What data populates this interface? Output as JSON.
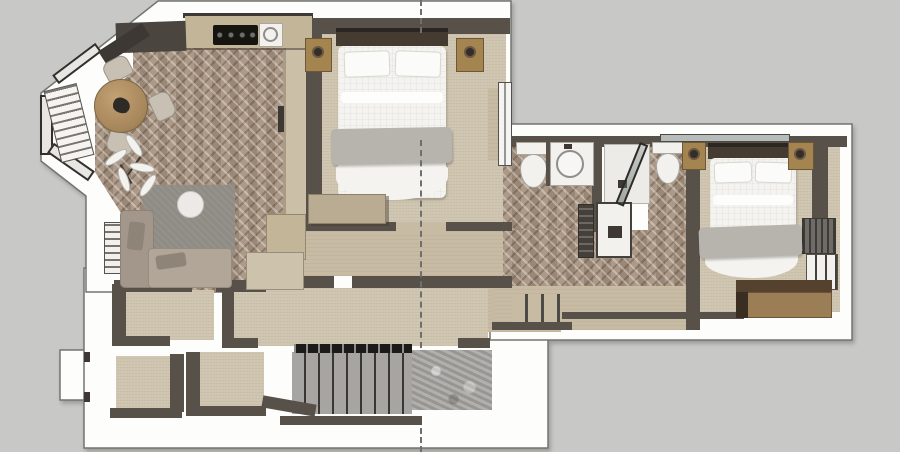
{
  "canvas": {
    "width": 900,
    "height": 452,
    "description": "3D rendered top-down apartment floor plan (SketchUp style), no visible text"
  },
  "palette": {
    "background": "#c8c9c6",
    "wall-white": "#fdfdfc",
    "wall-outline": "#74746f",
    "wall-dark": "#57514a",
    "wall-dark-2": "#3d3833",
    "parquet-base": "#a6917e",
    "carpet": "#cfc5b0",
    "corridor": "#c7bba4",
    "counter": "#c3b698",
    "cabinet-dark": "#4a453f",
    "wood": "#b2925f",
    "chair": "#c8c1b3",
    "sofa": "#b2a698",
    "sofa-2": "#a3968a",
    "rug": "#8e8c85",
    "table-white": "#eceae6",
    "bed-white": "#f4f3f0",
    "blanket": "#b7b4ad",
    "headboard": "#463b30",
    "nightstand": "#a5854f",
    "stone": "#a7a5a1",
    "railing": "#1d1b19",
    "fixture": "#f2f1ee",
    "fixture-line": "#a9a7a2",
    "dresser-top": "#54422f",
    "dresser-front": "#9b7e55",
    "radiator": "#6f6b66",
    "glass": "#b7bcbb",
    "section": "#6f6f6d"
  },
  "rooms": [
    {
      "id": "living-dining-kitchen",
      "floor": "herringbone-parquet",
      "furniture": [
        "kitchen-counter",
        "cooktop",
        "kitchen-sink",
        "tall-dark-cabinet",
        "round-dining-table",
        "dining-chairs",
        "bay-window",
        "window-bench",
        "plant",
        "corner-sofa",
        "area-rug",
        "round-coffee-table",
        "louvered-side-cabinet"
      ]
    },
    {
      "id": "bedroom-1",
      "floor": "carpet",
      "furniture": [
        "double-bed",
        "headboard",
        "pillows",
        "gray-blanket",
        "nightstand-left",
        "nightstand-right",
        "table-lamps",
        "dresser",
        "wardrobe-column",
        "window"
      ]
    },
    {
      "id": "bathroom-1",
      "floor": "herringbone-parquet",
      "furniture": [
        "toilet",
        "vanity-sink"
      ]
    },
    {
      "id": "shower-room",
      "floor": "tile-and-parquet",
      "furniture": [
        "shower-tray",
        "glass-door",
        "toilet"
      ]
    },
    {
      "id": "laundry-nook",
      "floor": "herringbone-parquet",
      "furniture": [
        "washing-machine",
        "tall-cabinet"
      ]
    },
    {
      "id": "bedroom-2",
      "floor": "carpet",
      "furniture": [
        "double-bed",
        "headboard",
        "pillows",
        "gray-blanket",
        "nightstand-left",
        "nightstand-right",
        "wardrobe",
        "radiator",
        "balcony-door",
        "dresser"
      ]
    },
    {
      "id": "hallway",
      "floor": "carpet",
      "furniture": [
        "steps"
      ]
    },
    {
      "id": "stair-hall",
      "floor": "stone",
      "furniture": [
        "staircase",
        "railing",
        "landing"
      ]
    },
    {
      "id": "lower-rooms",
      "floor": "carpet",
      "furniture": []
    }
  ],
  "annotations": {
    "section_line": {
      "orientation": "vertical",
      "style": "dashed",
      "x": 421,
      "visible_segments_y": [
        [
          0,
          33
        ],
        [
          140,
          348
        ],
        [
          428,
          452
        ]
      ]
    }
  }
}
